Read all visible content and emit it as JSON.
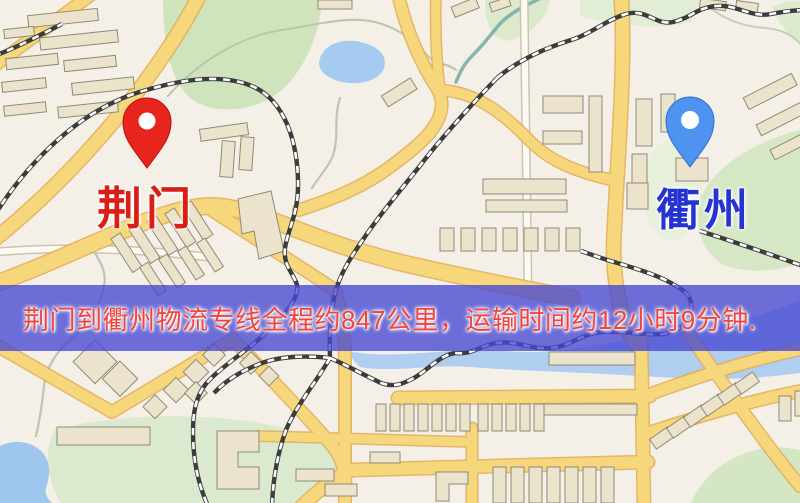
{
  "map": {
    "origin": {
      "name": "荆门",
      "pin_icon": "red-map-pin",
      "pin_color": "#e8251c"
    },
    "destination": {
      "name": "衢州",
      "pin_icon": "blue-map-pin",
      "pin_color": "#4f93f0"
    },
    "banner": {
      "text": "荆门到衢州物流专线全程约847公里，运输时间约12小时9分钟.",
      "distance_text": "约847公里",
      "duration_text": "约12小时9分钟"
    },
    "colors": {
      "background": "#f4f0e7",
      "road": "#f6d77c",
      "rail": "#3c3c3c",
      "building": "#ebe3cb",
      "park": "#cfe3bd",
      "water": "#a6cbf0",
      "origin_pin": "#e8251c",
      "origin_label": "#d91d17",
      "destination_pin": "#4f93f0",
      "destination_label": "#2533d2",
      "banner_bg": "rgba(70,72,212,0.78)",
      "banner_text": "#f2443a"
    }
  }
}
